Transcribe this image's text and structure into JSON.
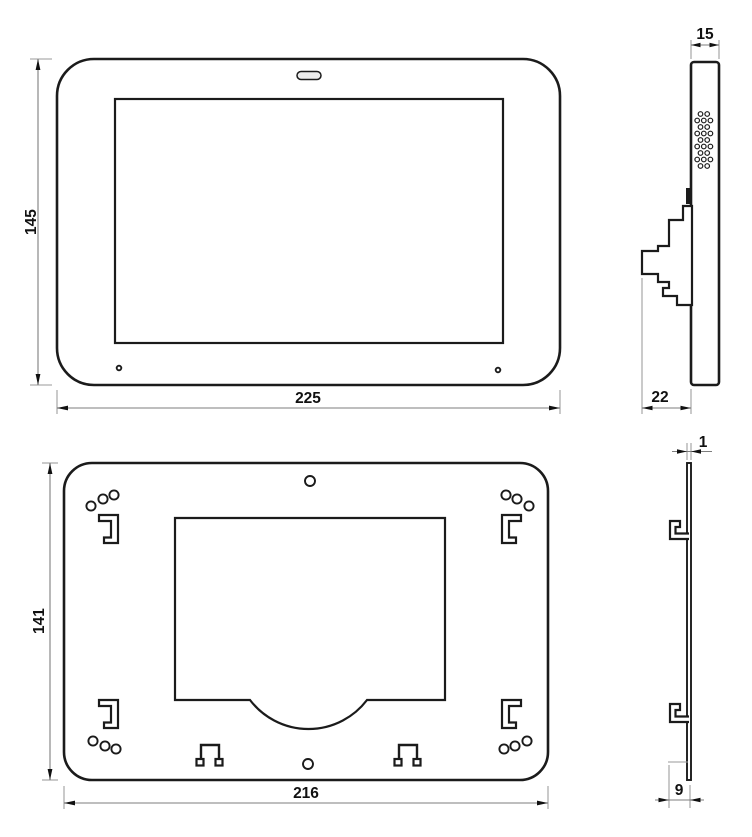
{
  "drawing": {
    "type": "engineering-dimension-drawing",
    "background": "#ffffff",
    "colors": {
      "object_line": "#1b1b1b",
      "dimension_line": "#7d7d7d",
      "extension_line": "#9a9a9a",
      "arrow": "#111111",
      "text": "#111111"
    },
    "views": {
      "front": {
        "dims": {
          "height": "145",
          "width": "225"
        }
      },
      "side": {
        "dims": {
          "thickness": "15",
          "mount_depth": "22"
        }
      },
      "plate": {
        "dims": {
          "height": "141",
          "width": "216"
        }
      },
      "plate_profile": {
        "dims": {
          "thickness": "1",
          "hook_depth": "9"
        }
      }
    }
  }
}
